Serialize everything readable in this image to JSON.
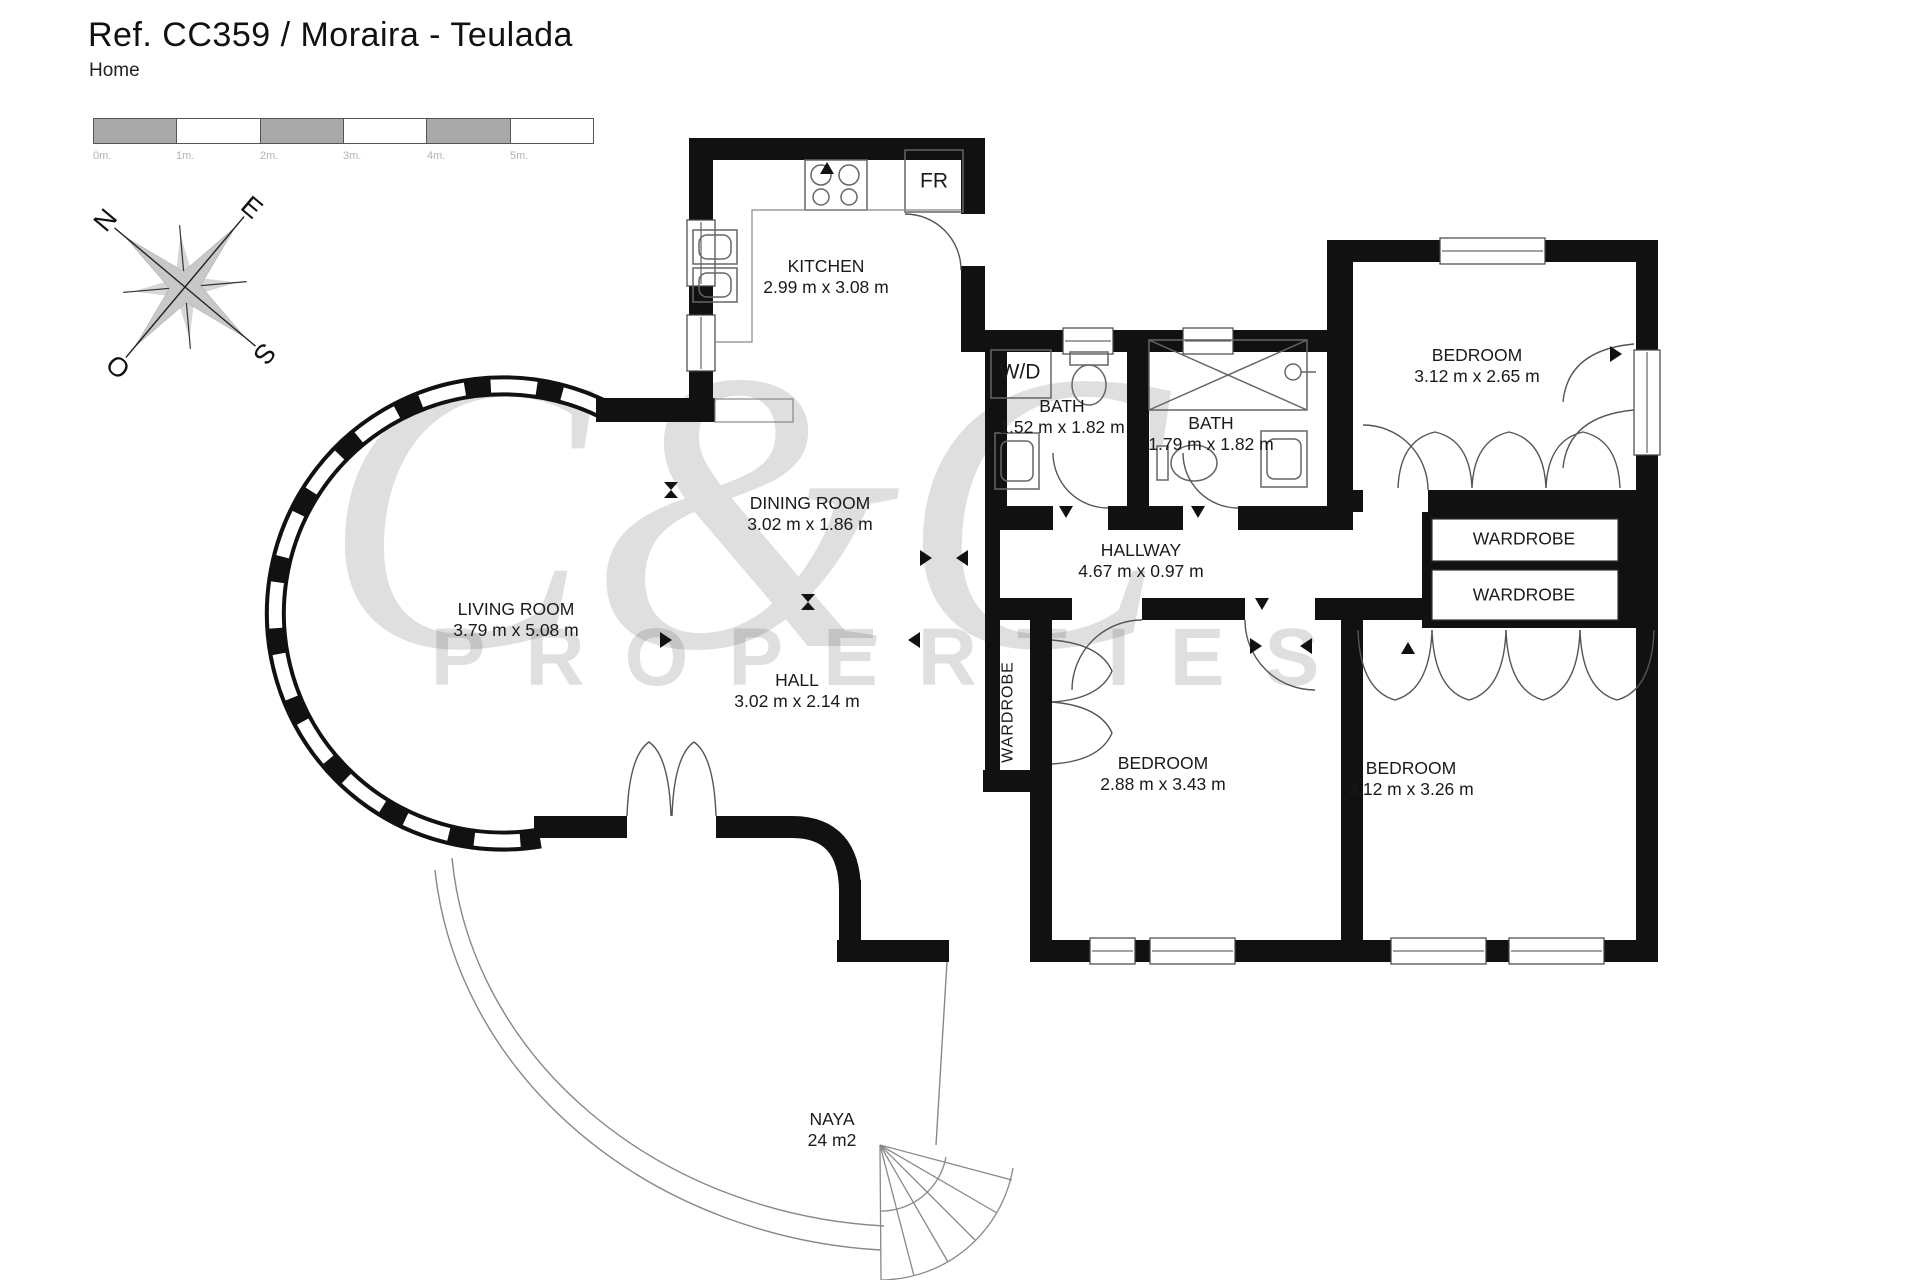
{
  "header": {
    "title": "Ref. CC359 / Moraira - Teulada",
    "subtitle": "Home"
  },
  "scale_bar": {
    "labels": [
      "0m.",
      "1m.",
      "2m.",
      "3m.",
      "4m.",
      "5m."
    ]
  },
  "compass": {
    "north": "N",
    "east": "E",
    "south": "S",
    "west": "O"
  },
  "watermark": {
    "brand": "C&C",
    "word": "PROPERTIES"
  },
  "fixtures": {
    "fridge": "FR",
    "washer_dryer": "W/D"
  },
  "rooms": {
    "kitchen": {
      "name": "KITCHEN",
      "dims": "2.99 m x 3.08 m"
    },
    "bath_small": {
      "name": "BATH",
      "dims": "1.52 m x 1.82 m"
    },
    "bath_large": {
      "name": "BATH",
      "dims": "1.79 m x 1.82 m"
    },
    "bedroom_top_right": {
      "name": "BEDROOM",
      "dims": "3.12 m x 2.65 m"
    },
    "dining_room": {
      "name": "DINING ROOM",
      "dims": "3.02 m x 1.86 m"
    },
    "hallway": {
      "name": "HALLWAY",
      "dims": "4.67 m x 0.97 m"
    },
    "living_room": {
      "name": "LIVING ROOM",
      "dims": "3.79 m x 5.08 m"
    },
    "hall": {
      "name": "HALL",
      "dims": "3.02 m x 2.14 m"
    },
    "bedroom_middle": {
      "name": "BEDROOM",
      "dims": "2.88 m x 3.43 m"
    },
    "bedroom_bottom_right": {
      "name": "BEDROOM",
      "dims": "3.12 m x 3.26 m"
    },
    "wardrobe_upper": {
      "name": "WARDROBE"
    },
    "wardrobe_lower": {
      "name": "WARDROBE"
    },
    "wardrobe_vertical": {
      "name": "WARDROBE"
    },
    "naya": {
      "name": "NAYA",
      "dims": "24 m2"
    }
  }
}
